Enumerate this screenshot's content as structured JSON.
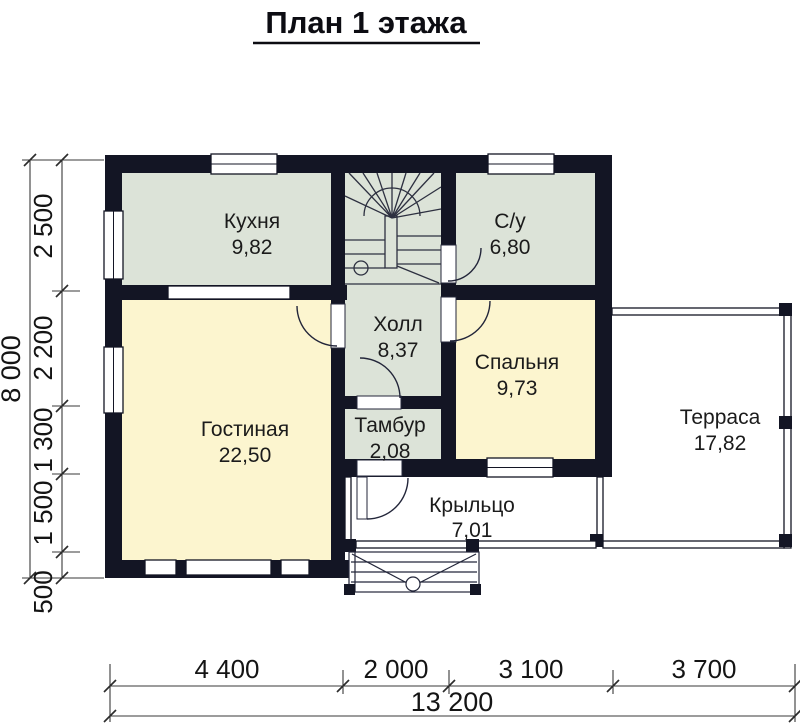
{
  "title": "План 1 этажа",
  "rooms": [
    {
      "name": "Кухня",
      "area": "9,82"
    },
    {
      "name": "С/у",
      "area": "6,80"
    },
    {
      "name": "Холл",
      "area": "8,37"
    },
    {
      "name": "Спальня",
      "area": "9,73"
    },
    {
      "name": "Гостиная",
      "area": "22,50"
    },
    {
      "name": "Тамбур",
      "area": "2,08"
    },
    {
      "name": "Крыльцо",
      "area": "7,01"
    },
    {
      "name": "Терраса",
      "area": "17,82"
    }
  ],
  "dimensions": {
    "vertical": {
      "total": "8 000",
      "segments": [
        "2 500",
        "2 200",
        "1 300",
        "1 500",
        "500"
      ]
    },
    "horizontal": {
      "total": "13 200",
      "segments": [
        "4 400",
        "2 000",
        "3 100",
        "3 700"
      ]
    }
  },
  "colors": {
    "wall": "#131524",
    "service_room_fill": "#dce3d8",
    "living_room_fill": "#fcf5cf",
    "outdoor_fill": "#ffffff",
    "dimension_line": "#3a3a3a",
    "text": "#1b1b1b"
  }
}
